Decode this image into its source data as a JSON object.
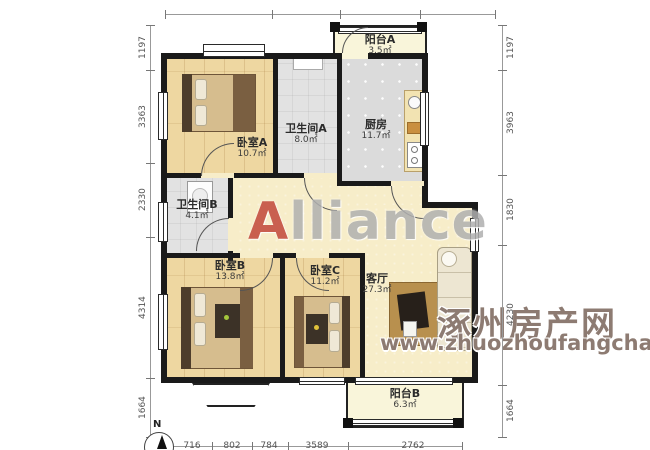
{
  "plan": {
    "rooms": [
      {
        "name": "阳台A",
        "area": "3.5㎡"
      },
      {
        "name": "卧室A",
        "area": "10.7㎡"
      },
      {
        "name": "卫生间A",
        "area": "8.0㎡"
      },
      {
        "name": "厨房",
        "area": "11.7㎡"
      },
      {
        "name": "卫生间B",
        "area": "4.1㎡"
      },
      {
        "name": "卧室B",
        "area": "13.8㎡"
      },
      {
        "name": "卧室C",
        "area": "11.2㎡"
      },
      {
        "name": "客厅",
        "area": "27.3㎡"
      },
      {
        "name": "阳台B",
        "area": "6.3㎡"
      }
    ]
  },
  "dimensions": {
    "top": [
      "2900",
      "2915",
      "2547",
      "2925"
    ],
    "bottom": [
      "716",
      "802",
      "784",
      "3589",
      "2762"
    ],
    "left": [
      "1197",
      "3363",
      "2330",
      "4314",
      "1664"
    ],
    "right": [
      "1197",
      "3963",
      "1830",
      "4230",
      "1664"
    ]
  },
  "watermarks": {
    "alliance_a": "A",
    "alliance_rest": "lliance",
    "site_name": "涿州房产网",
    "site_url": "www.zhuozhoufangchan.com"
  },
  "compass": {
    "north_label": "N"
  },
  "colors": {
    "wall": "#1a1a1a",
    "wood_floor": "#eed7a1",
    "tile_floor": "#e2e2e2",
    "hall_floor": "#f7edc9",
    "balcony_floor": "#f9f5da",
    "watermark_site": "#8d7b72",
    "watermark_alliance_a": "#c2473a",
    "watermark_alliance_rest": "#b0b0b0"
  }
}
